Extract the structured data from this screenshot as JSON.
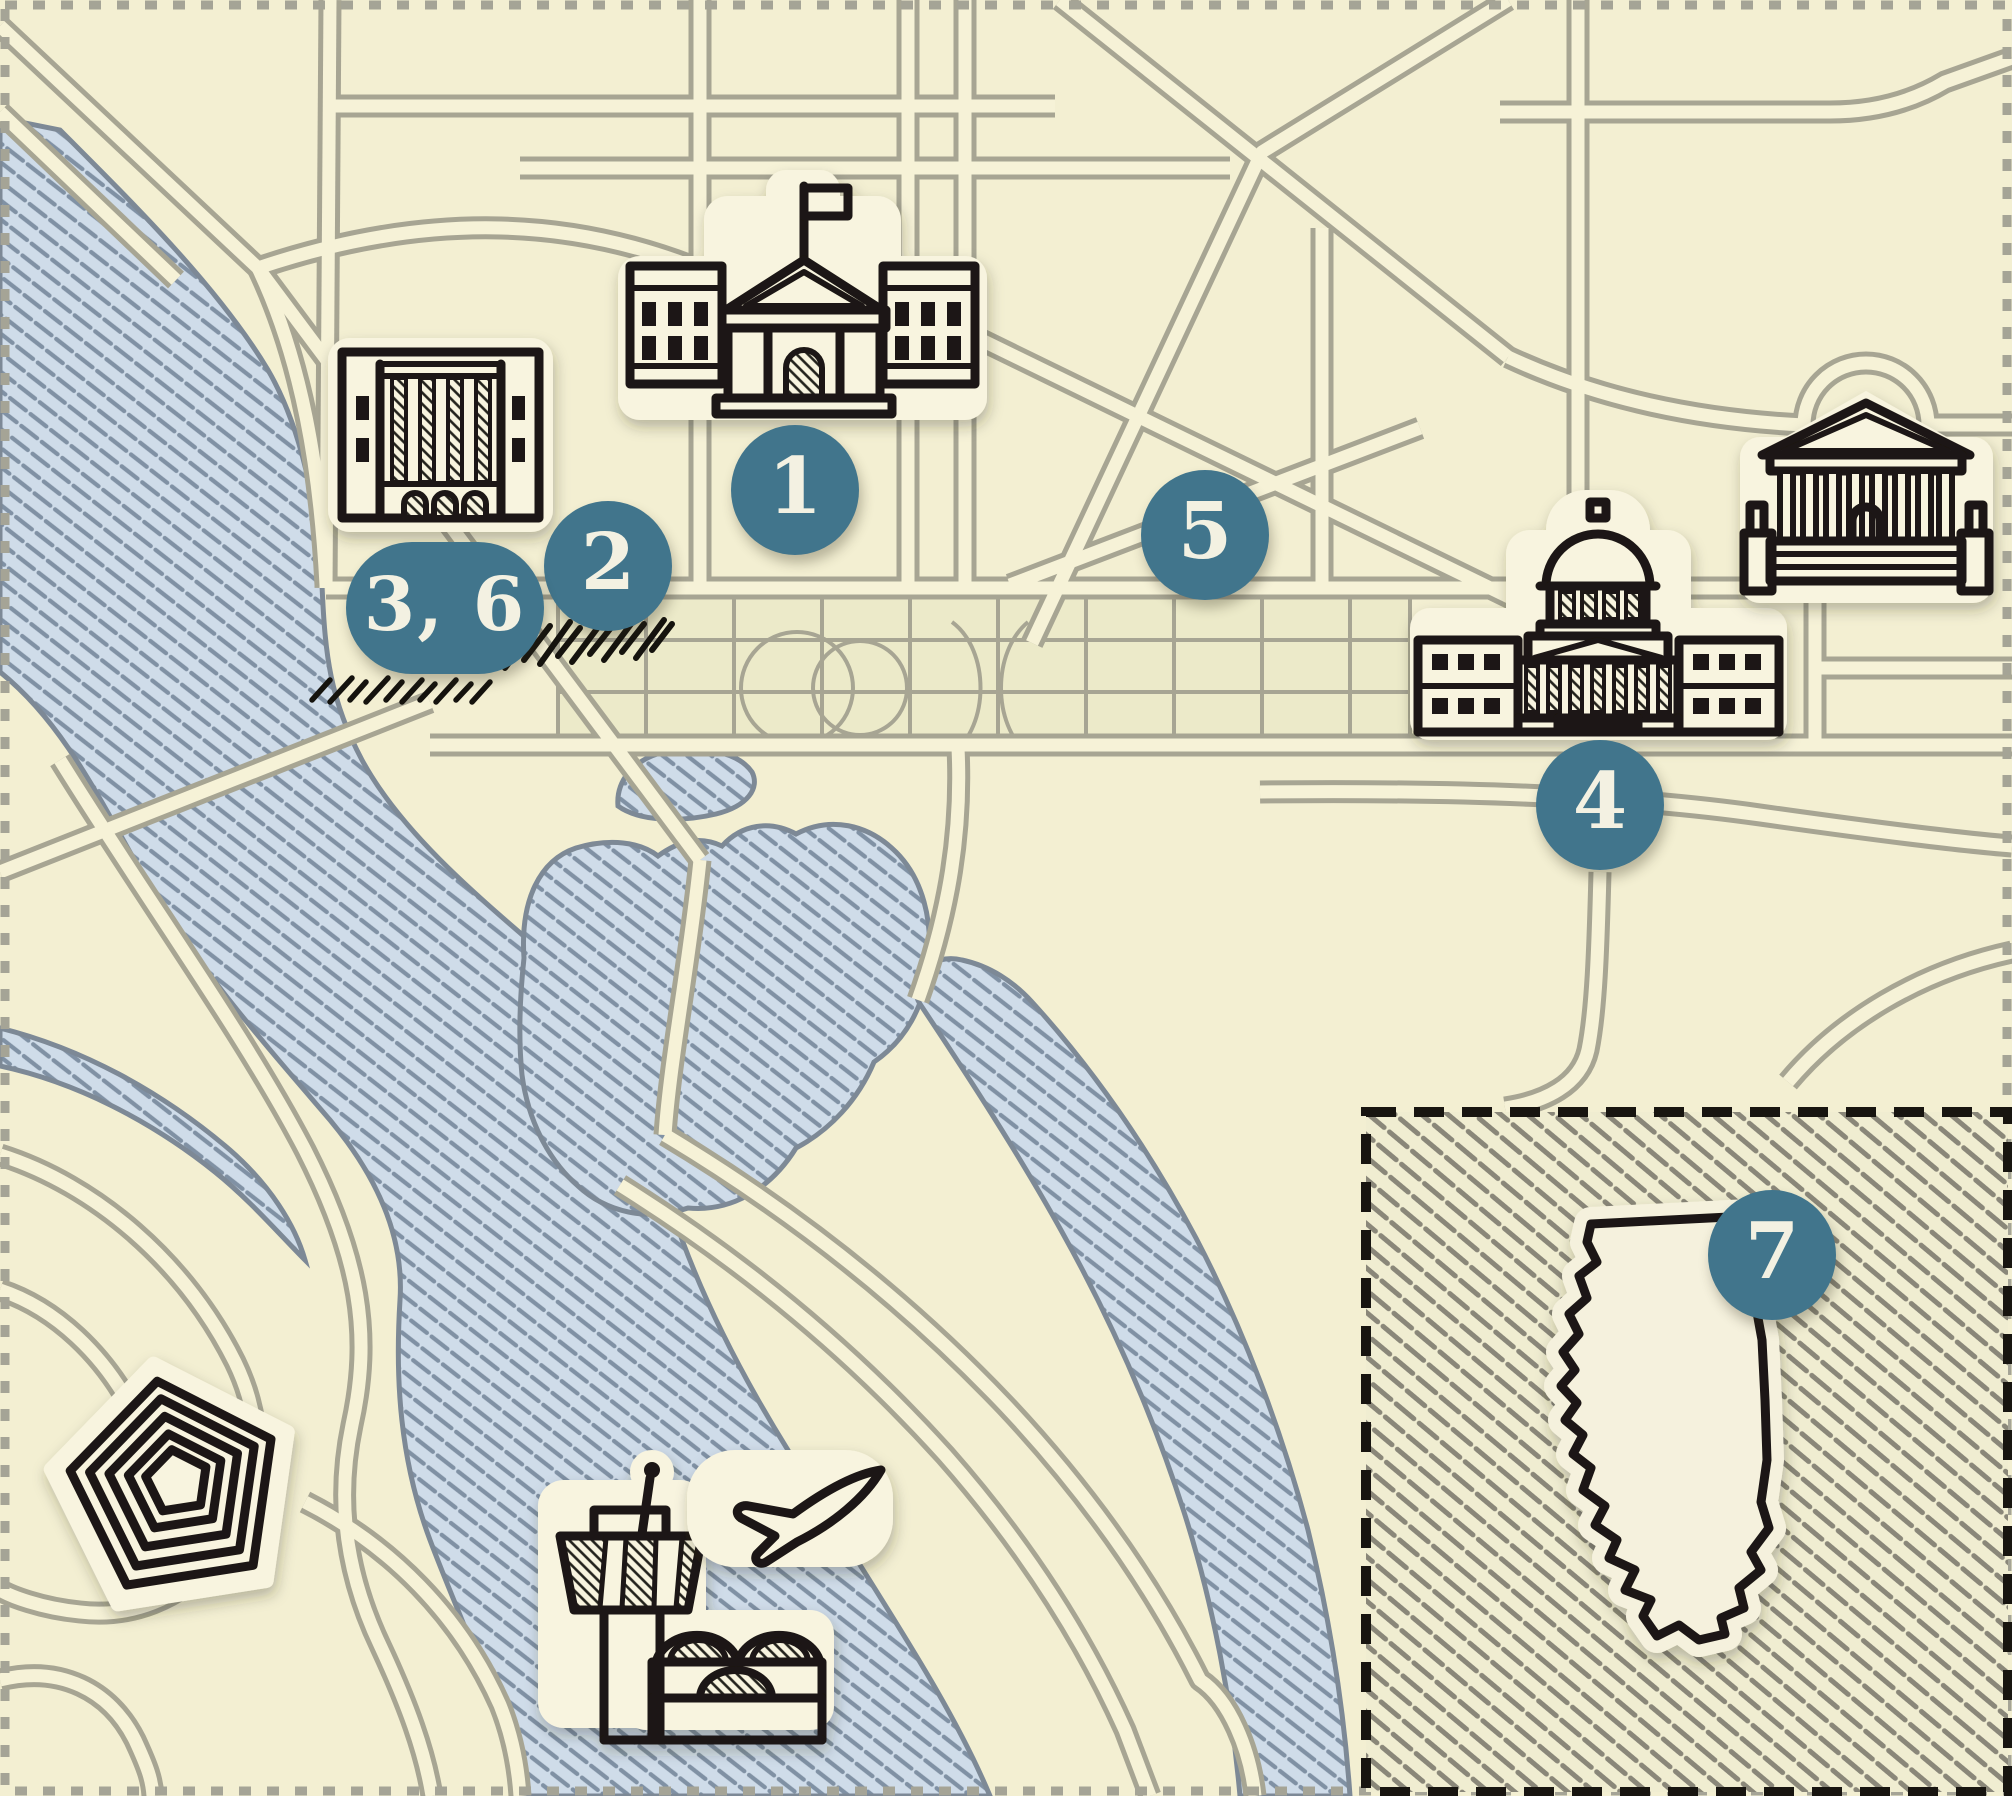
{
  "map": {
    "type": "illustrated-city-map",
    "city_theme": "national-mall-area",
    "visible_text_items": [
      "1",
      "2",
      "3, 6",
      "4",
      "5",
      "7"
    ]
  },
  "markers": [
    {
      "id": "marker-1",
      "label": "1",
      "x": 795,
      "y": 490,
      "shape": "circle"
    },
    {
      "id": "marker-2",
      "label": "2",
      "x": 608,
      "y": 566,
      "shape": "circle"
    },
    {
      "id": "marker-3-6",
      "label": "3, 6",
      "x": 445,
      "y": 608,
      "shape": "pill"
    },
    {
      "id": "marker-4",
      "label": "4",
      "x": 1600,
      "y": 805,
      "shape": "circle"
    },
    {
      "id": "marker-5",
      "label": "5",
      "x": 1205,
      "y": 535,
      "shape": "circle"
    },
    {
      "id": "marker-7",
      "label": "7",
      "x": 1772,
      "y": 1255,
      "shape": "circle"
    }
  ],
  "icons": [
    {
      "name": "white-house-icon"
    },
    {
      "name": "classical-building-icon"
    },
    {
      "name": "capitol-icon"
    },
    {
      "name": "supreme-court-icon"
    },
    {
      "name": "pentagon-icon"
    },
    {
      "name": "airport-tower-icon"
    },
    {
      "name": "airplane-icon"
    },
    {
      "name": "illinois-state-icon"
    }
  ],
  "inset": {
    "contains": "illinois-state-icon",
    "marker": "7"
  },
  "colors": {
    "land": "#f3efd2",
    "road_fill": "#f6f2d7",
    "road_casing": "#a7a593",
    "water_fill": "#cfdce9",
    "water_hatch": "#6d7e92",
    "water_outline": "#7d8996",
    "sticker": "#f8f4df",
    "ink": "#1c1812",
    "marker_teal": "#41758c",
    "marker_text": "#f3f1e2",
    "inset_hatch": "#8a8779"
  }
}
